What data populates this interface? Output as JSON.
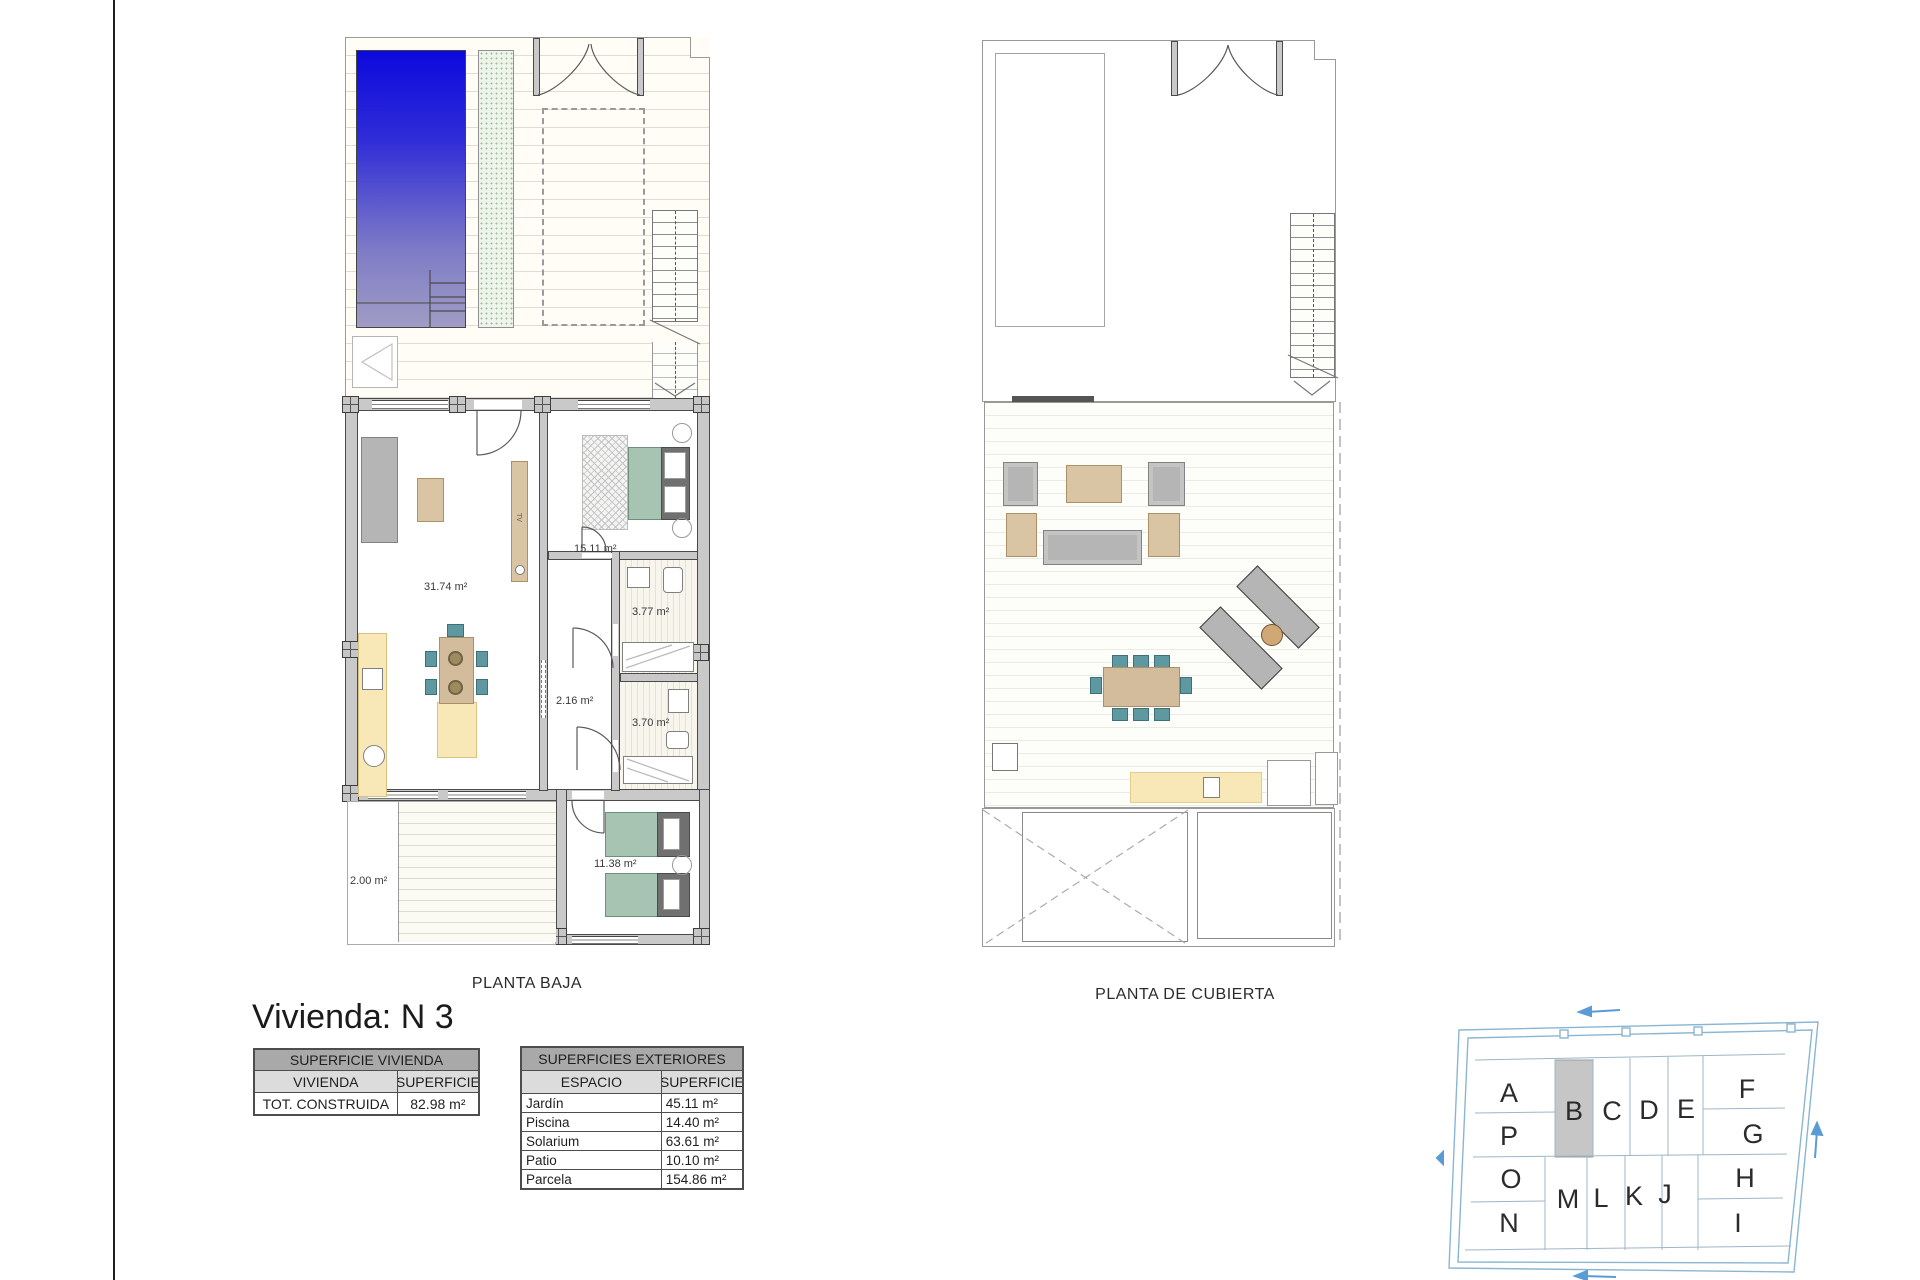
{
  "title": "Vivienda: N 3",
  "plans": {
    "ground": {
      "caption": "PLANTA BAJA",
      "tv_label": "TV",
      "room_labels": {
        "living": "31.74 m²",
        "bedroom_main": "15.11 m²",
        "bathroom_1": "3.77 m²",
        "hall": "2.16 m²",
        "bathroom_2": "3.70 m²",
        "bedroom_2": "11.38 m²",
        "side_patio": "2.00 m²"
      }
    },
    "roof": {
      "caption": "PLANTA DE CUBIERTA"
    }
  },
  "surface_tables": {
    "vivienda": {
      "title": "SUPERFICIE VIVIENDA",
      "headers": [
        "VIVIENDA",
        "SUPERFICIE"
      ],
      "rows": [
        {
          "label": "TOT. CONSTRUIDA",
          "value": "82.98 m²"
        }
      ]
    },
    "exteriores": {
      "title": "SUPERFICIES EXTERIORES",
      "headers": [
        "ESPACIO",
        "SUPERFICIE"
      ],
      "rows": [
        {
          "label": "Jardín",
          "value": "45.11 m²"
        },
        {
          "label": "Piscina",
          "value": "14.40 m²"
        },
        {
          "label": "Solarium",
          "value": "63.61 m²"
        },
        {
          "label": "Patio",
          "value": "10.10 m²"
        },
        {
          "label": "Parcela",
          "value": "154.86 m²"
        }
      ]
    }
  },
  "site_plan": {
    "highlighted_unit": "B",
    "units": {
      "A": "A",
      "P": "P",
      "O": "O",
      "N": "N",
      "B": "B",
      "C": "C",
      "D": "D",
      "E": "E",
      "F": "F",
      "G": "G",
      "M": "M",
      "L": "L",
      "K": "K",
      "J": "J",
      "H": "H",
      "I": "I"
    }
  },
  "colors": {
    "pool_top": "#0d09dd",
    "pool_bottom": "#a09cc4",
    "wall_gray": "#c9c9c9",
    "furniture_tan": "#d9c4a3",
    "chair_teal": "#5e98a0",
    "bed_green": "#a7c3b2",
    "kitchen_yellow": "#f8e7b7",
    "site_outline_blue": "#8ab6d2",
    "highlight_gray": "#c6c6c6",
    "arrow_blue": "#5b9bd5"
  }
}
